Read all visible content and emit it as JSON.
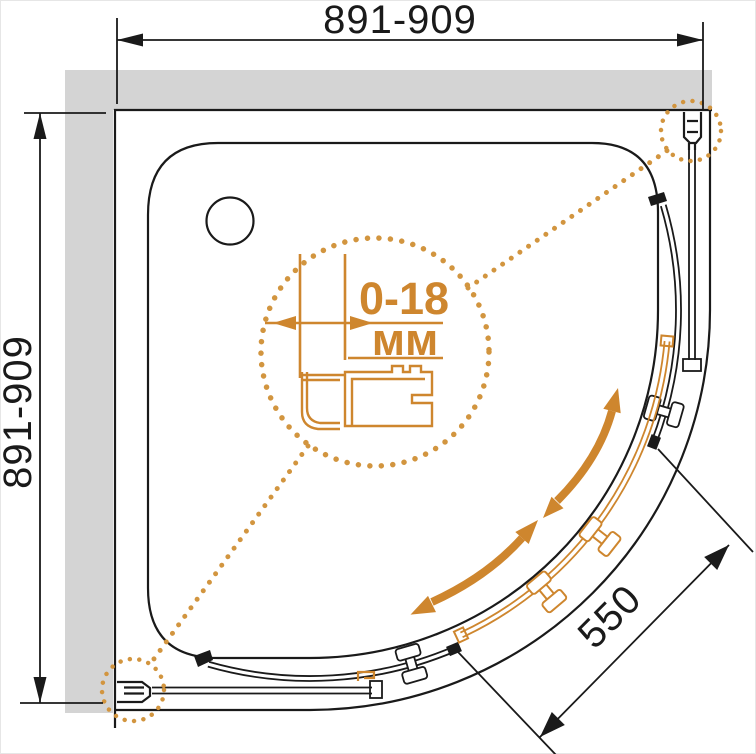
{
  "diagram": {
    "kind": "shower-enclosure-top-view-dimension-drawing"
  },
  "dimensions": {
    "width_top": "891-909",
    "depth_left": "891-909",
    "door_opening": "550",
    "adjustment_range": "0-18",
    "adjustment_unit": "мм"
  },
  "colors": {
    "accent_orange": "#CE862E",
    "accent_dots": "#D2953F",
    "wall_gray": "#D4D4D4",
    "line_black": "#1A1A1A",
    "background": "#FFFFFF"
  }
}
